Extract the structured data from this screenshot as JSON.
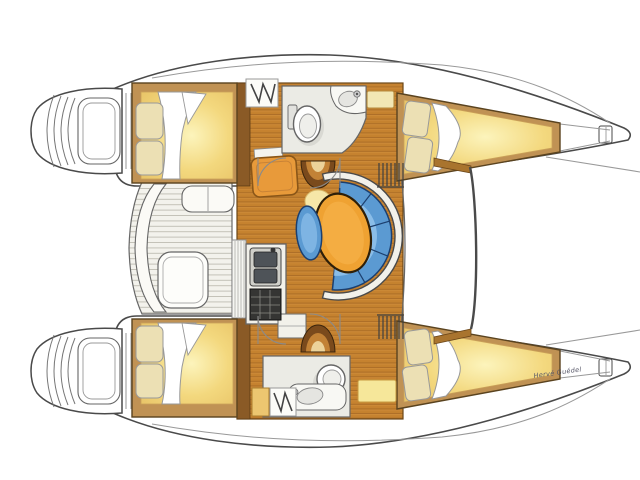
{
  "signature": "Hervé Guédel",
  "palette": {
    "hull_line": "#4a4a4a",
    "wood_base": "#c5822f",
    "wood_dark": "#9a6020",
    "wood_highlight": "#e0a050",
    "wood_trim": "#6b4618",
    "bulkhead": "#8a5a26",
    "bed_frame": "#c09254",
    "bed_frame_edge": "#5a431f",
    "mattress_glow": "#fcf4bc",
    "mattress": "#f3d87e",
    "mattress_edge": "#e7c164",
    "pillow": "#ece0b4",
    "sofa_blue": "#5b9ad2",
    "sofa_blue_light": "#96c6ee",
    "sofa_outline": "#1c3f6e",
    "table_orange": "#efa232",
    "table_outline": "#2e1f08",
    "nav_orange": "#e89a3a",
    "nav_outline": "#8a5618",
    "floor_white": "#f2f1ea",
    "bath_floor": "#ebebe5",
    "fixture_gray": "#cfcfc9",
    "basin_dark": "#4e5358",
    "stove_dark": "#353533",
    "stove_grid": "#8a8a84",
    "steps_brown": "#7a4a1c",
    "steps_mid": "#c28236",
    "steps_light": "#ecd39a",
    "glow_pale": "#f6e7a8",
    "locker_yellow": "#f2e7b4",
    "locker_gold": "#ecc670",
    "slat_bg": "#f3f2ec",
    "slat_line": "#c3c1b7",
    "beam_wedge": "#a9742e"
  }
}
